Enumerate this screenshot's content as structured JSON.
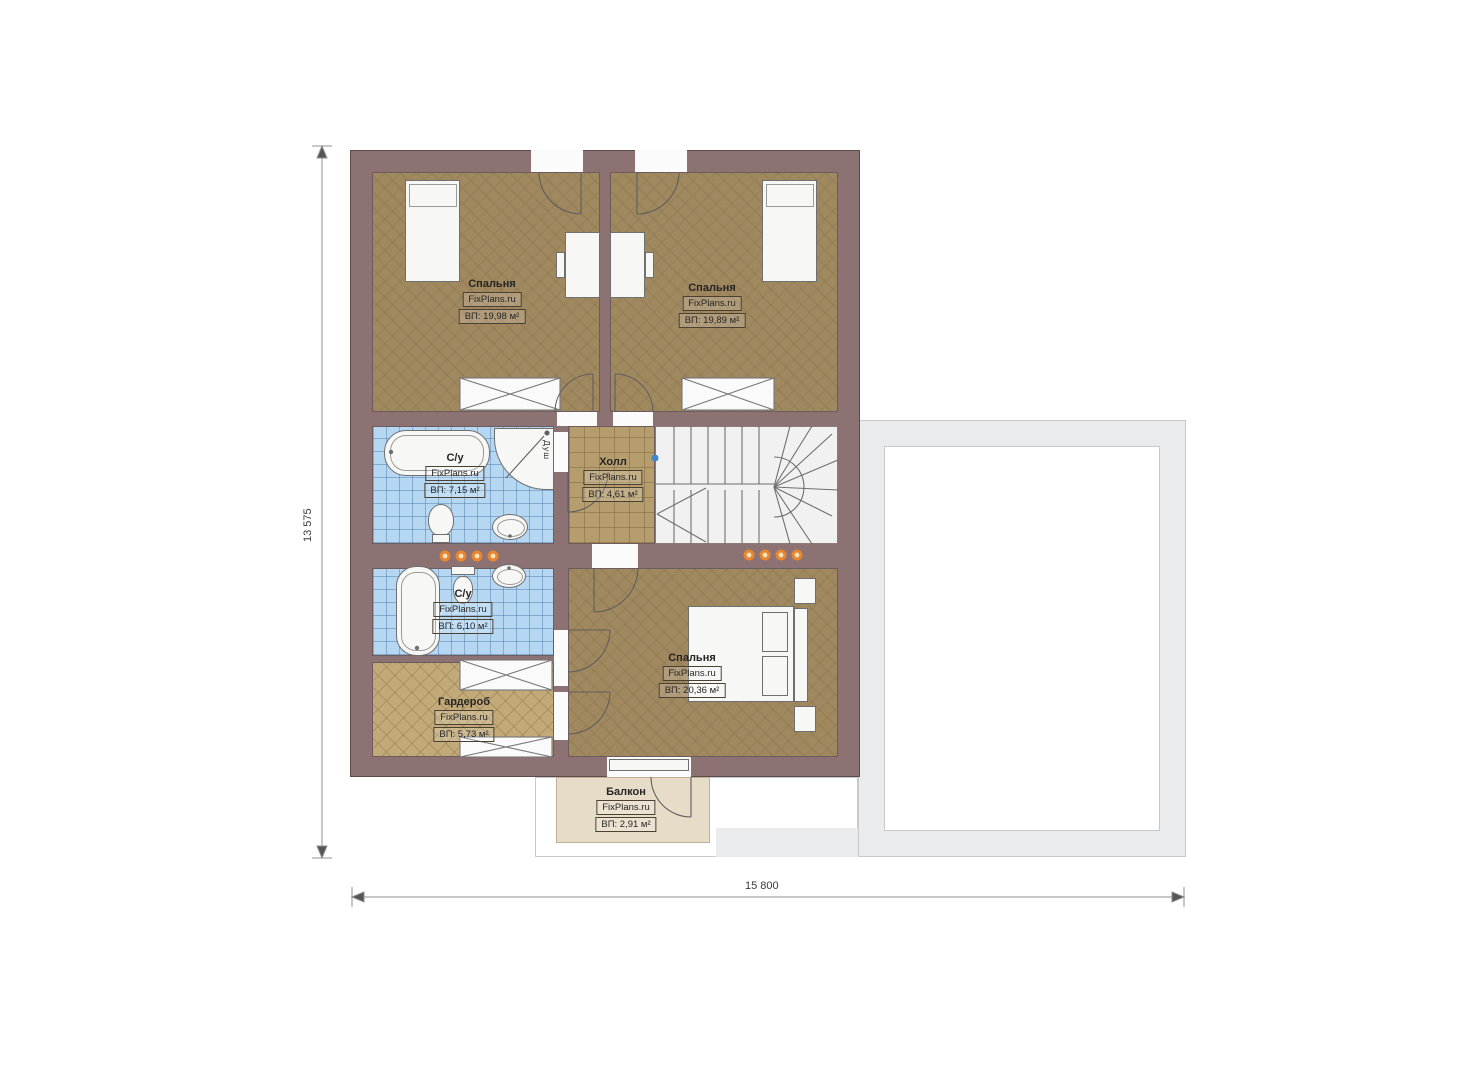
{
  "plan": {
    "dim_height": "13 575",
    "dim_width": "15 800",
    "shower_label": "Душ",
    "rooms": [
      {
        "name": "Спальня",
        "site": "FixPlans.ru",
        "area": "ВП: 19,98 м²"
      },
      {
        "name": "Спальня",
        "site": "FixPlans.ru",
        "area": "ВП: 19,89 м²"
      },
      {
        "name": "С/у",
        "site": "FixPlans.ru",
        "area": "ВП: 7,15 м²"
      },
      {
        "name": "Холл",
        "site": "FixPlans.ru",
        "area": "ВП: 4,61 м²"
      },
      {
        "name": "С/у",
        "site": "FixPlans.ru",
        "area": "ВП: 6,10 м²"
      },
      {
        "name": "Гардероб",
        "site": "FixPlans.ru",
        "area": "ВП: 5,73 м²"
      },
      {
        "name": "Спальня",
        "site": "FixPlans.ru",
        "area": "ВП: 20,36 м²"
      },
      {
        "name": "Балкон",
        "site": "FixPlans.ru",
        "area": "ВП: 2,91 м²"
      }
    ],
    "colors": {
      "wall": "#8c7272",
      "bedroom_floor": "#a0885f",
      "hall_tile": "#b59d6d",
      "wardrobe_tile": "#c2aa78",
      "bathroom_tile": "#b5d7f2",
      "balcony": "#e7dcc7",
      "roof_outline": "#e9ebed",
      "wall_lights": "#e8862f"
    }
  }
}
